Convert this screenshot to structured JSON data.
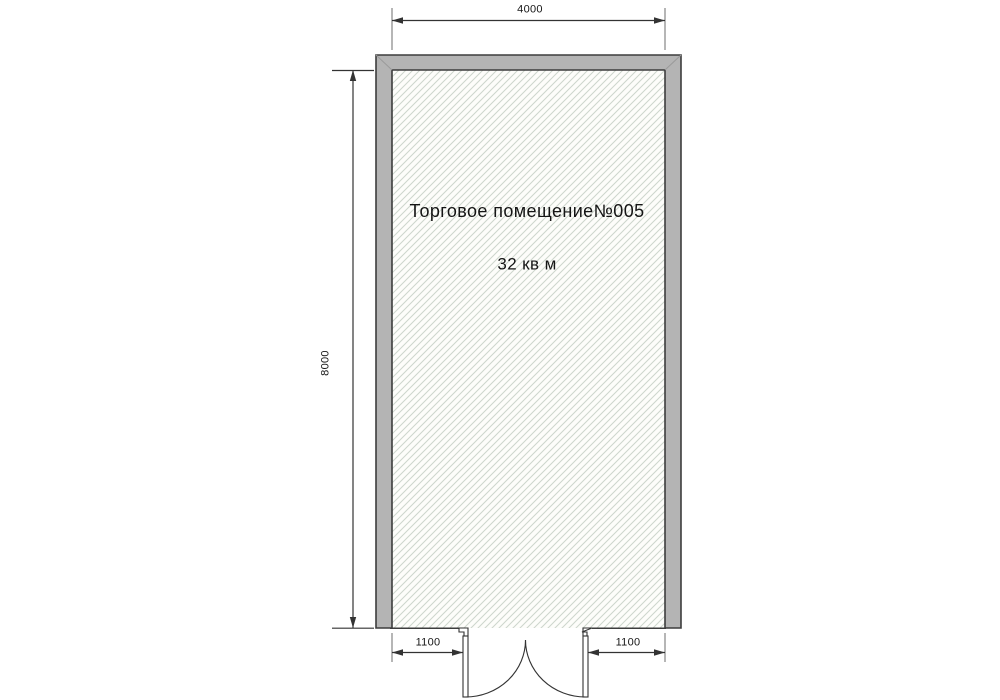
{
  "room": {
    "name": "Торговое помещение№005",
    "area": "32 кв м"
  },
  "dimensions": {
    "width_top": "4000",
    "height_left": "8000",
    "door_offset_left": "1100",
    "door_offset_right": "1100"
  },
  "colors": {
    "wall_fill": "#b4b4b4",
    "wall_outline": "#3d3d3d",
    "miter_line": "#9a9a9a",
    "floor_fill": "#fdfdfa",
    "hatch_line": "#cdd6cc",
    "line": "#333333",
    "extension_line": "#6e6e6e",
    "door_fill": "#ffffff",
    "text": "#151515",
    "background": "#ffffff"
  }
}
